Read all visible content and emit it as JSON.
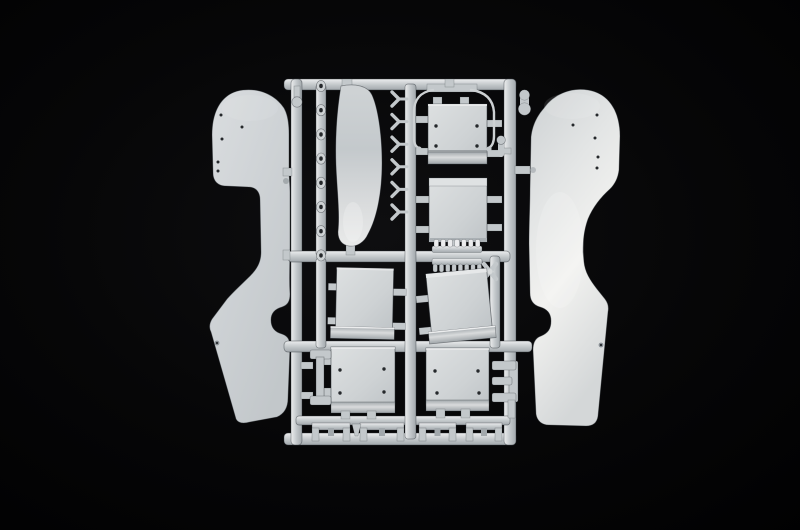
{
  "scene": {
    "description": "Studio photograph of a light-grey injection-moulded plastic model kit sprue (parts frame) lying on a black background. A rectangular runner frame in the centre holds six rectangular hull/hatch panels, a curved wheel-arch strip, a column of chain links, a column of Y-shaped clips, two rows of small track teeth, wire grab-handles, channel brackets and small clips. Two large mirrored fender side-panels with rivet holes flank the frame on the left and right.",
    "background": {
      "base": "#010102",
      "glow": "#0e0e10"
    },
    "plastic": {
      "light": "#ecedee",
      "mid": "#ced2d4",
      "base": "#c3c8cb",
      "shadow": "#a2a8ac",
      "dark": "#7e858a",
      "hole": "#25282b",
      "bright": "#f2f2f0"
    },
    "counts": {
      "chain_links": 8,
      "y_clips": 6,
      "teeth_top": 7,
      "teeth_bottom": 8,
      "wire_handles": 2,
      "channel_brackets": 4,
      "panels": 6,
      "fender_holes_each": 5
    },
    "parts": [
      {
        "name": "left-fender-panel",
        "detail": "rounded dome top, wheel cut-out, 5 rivet holes, 1 rivet"
      },
      {
        "name": "right-fender-panel",
        "detail": "mirrored fender, bright specular highlight, 5 rivet holes, 1 rivet"
      },
      {
        "name": "wheel-arch-strip",
        "detail": "curved mudguard blade"
      },
      {
        "name": "hatch-panel-top-right",
        "detail": "square hatch, 2 hinge tabs, 4 rivets"
      },
      {
        "name": "hatch-panel-right-second",
        "detail": "plain hatch with top ridge"
      },
      {
        "name": "hull-panel-mid-left",
        "detail": "panel with bottom ridge lip"
      },
      {
        "name": "hull-panel-mid-right",
        "detail": "tilted panel with bottom ridge"
      },
      {
        "name": "hull-panel-bottom-left",
        "detail": "4 rivet pins, bottom ridge, feet tabs"
      },
      {
        "name": "hull-panel-bottom-right",
        "detail": "4 rivet pins, bottom ridge, feet tabs"
      },
      {
        "name": "chain-link-column",
        "detail": "8 small eyelet links on inner runner"
      },
      {
        "name": "y-clip-column",
        "detail": "6 wishbone clips on central runner"
      },
      {
        "name": "track-teeth-strips",
        "detail": "two combs of small teeth"
      },
      {
        "name": "wire-handles",
        "detail": "two thin arched rods over top hatch"
      },
      {
        "name": "channel-brackets",
        "detail": "4 staple-shaped channels on bottom runner"
      },
      {
        "name": "i-bracket",
        "detail": "flanged beam left of bottom panel"
      },
      {
        "name": "e-bracket",
        "detail": "E-shaped bracket right of bottom panel"
      },
      {
        "name": "small-clips",
        "detail": "teardrop clip, twin-lobe capsule, ball lever"
      }
    ]
  }
}
